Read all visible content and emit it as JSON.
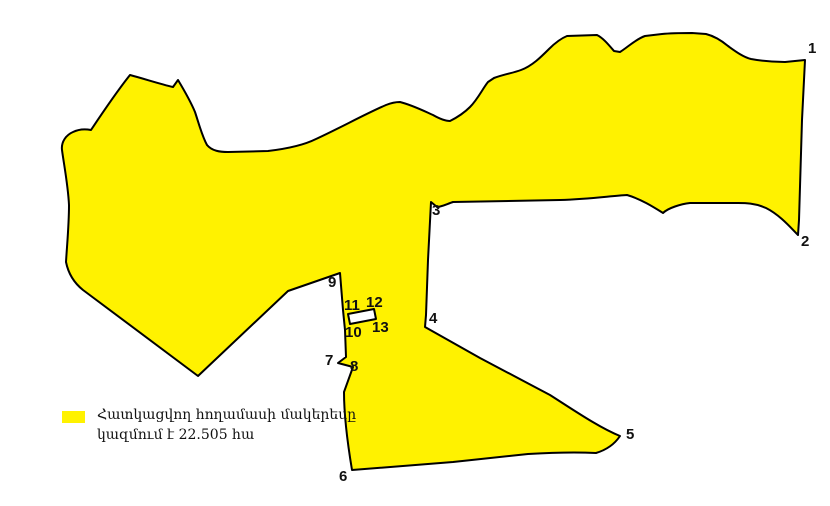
{
  "legend": {
    "swatch_color": "#FFF200",
    "line1": "Հատկացվող հողամասի մակերեսը",
    "line2": "կազմում է 22.505 հա"
  },
  "map": {
    "background_color": "#FFFFFF",
    "parcel_fill_color": "#FFF200",
    "outline_color": "#000000",
    "excluded_plot_points": "348,314 374,309 376,319 350,324",
    "vertex_labels": [
      {
        "label": "1",
        "x": 808,
        "y": 41
      },
      {
        "label": "2",
        "x": 801,
        "y": 234
      },
      {
        "label": "3",
        "x": 432,
        "y": 203
      },
      {
        "label": "4",
        "x": 429,
        "y": 311
      },
      {
        "label": "5",
        "x": 626,
        "y": 427
      },
      {
        "label": "6",
        "x": 339,
        "y": 469
      },
      {
        "label": "7",
        "x": 325,
        "y": 353
      },
      {
        "label": "8",
        "x": 350,
        "y": 359
      },
      {
        "label": "9",
        "x": 328,
        "y": 275
      },
      {
        "label": "10",
        "x": 345,
        "y": 325
      },
      {
        "label": "11",
        "x": 344,
        "y": 298
      },
      {
        "label": "12",
        "x": 366,
        "y": 295
      },
      {
        "label": "13",
        "x": 372,
        "y": 320
      }
    ]
  }
}
